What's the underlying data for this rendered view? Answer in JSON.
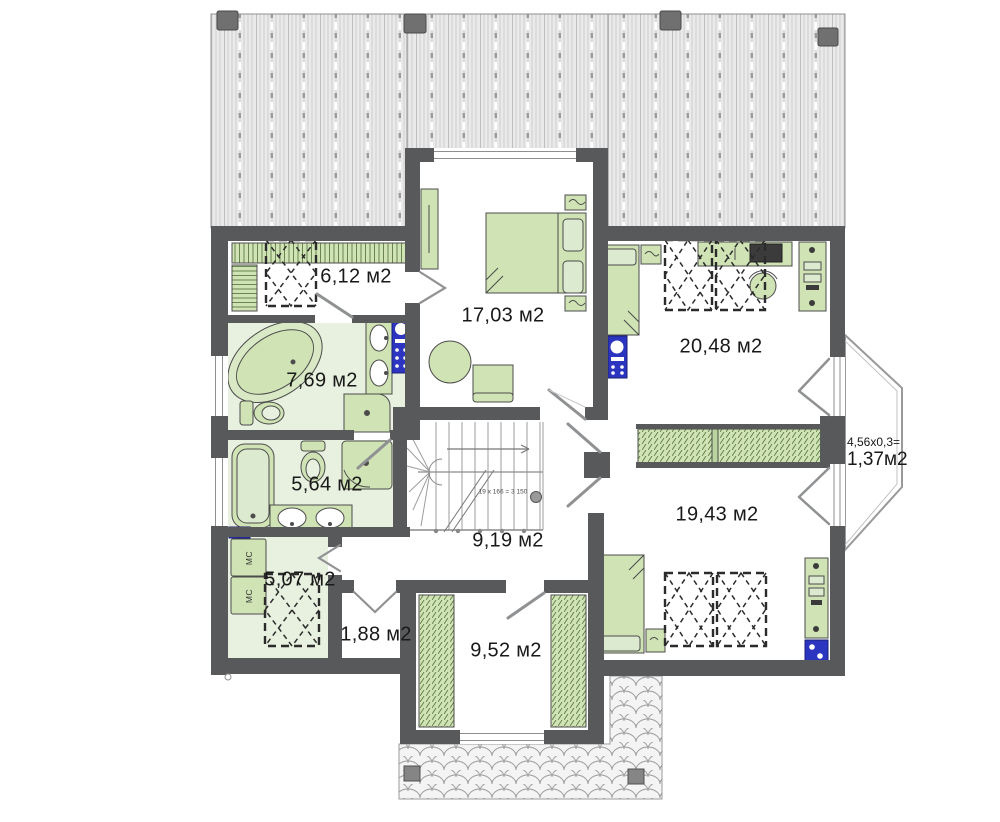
{
  "rooms": {
    "closet_top": {
      "area": "6,12 м2"
    },
    "bedroom_main": {
      "area": "17,03 м2"
    },
    "bedroom_right_top": {
      "area": "20,48 м2"
    },
    "bathroom_main": {
      "area": "7,69 м2"
    },
    "bathroom_second": {
      "area": "5,64 м2"
    },
    "stair_hall": {
      "area": "9,19 м2"
    },
    "laundry": {
      "area": "5,07 м2"
    },
    "closet_small": {
      "area": "1,88 м2"
    },
    "wardrobe_room": {
      "area": "9,52 м2"
    },
    "bedroom_right_bottom": {
      "area": "19,43 м2"
    }
  },
  "balcony": {
    "dimensions": "4,56x0,3=",
    "area": "1,37м2"
  },
  "stairs": {
    "note": "19 x 166 = 3 150"
  },
  "appliances": {
    "washer_label_1": "МС",
    "washer_label_2": "МС"
  },
  "colors": {
    "wall": "#58595b",
    "furniture_green": "#cfe3b4",
    "floor_green": "#e8f0df",
    "fixture_blue": "#2c35bf",
    "roof_stripe": "#c8c8c8",
    "skylight_dash": "#2b2b2b"
  }
}
